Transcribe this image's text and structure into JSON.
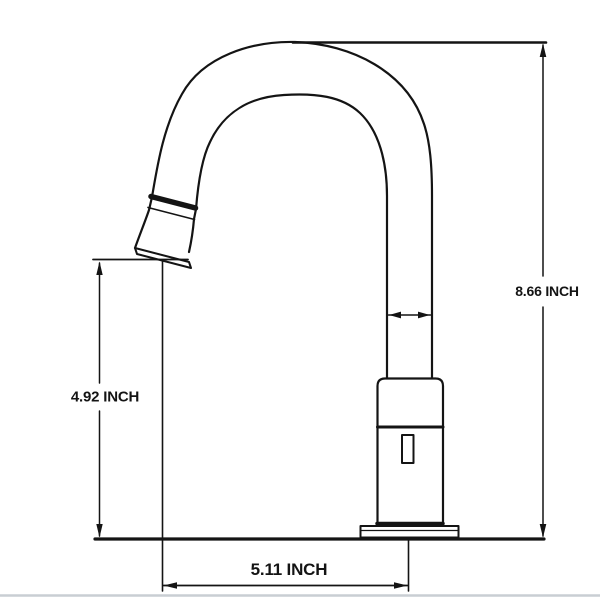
{
  "diagram": {
    "type": "technical-dimension-drawing",
    "subject": "gooseneck faucet side view",
    "unit": "INCH",
    "dimensions": {
      "total_height": {
        "value": "8.66",
        "unit": "INCH",
        "label": "8.66 INCH"
      },
      "spout_outlet_height": {
        "value": "4.92",
        "unit": "INCH",
        "label": "4.92 INCH"
      },
      "spout_reach": {
        "value": "5.11",
        "unit": "INCH",
        "label": "5.11 INCH"
      }
    },
    "colors": {
      "line": "#141414",
      "background": "#ffffff",
      "ground_shadow_line": "#c9ced3"
    }
  }
}
